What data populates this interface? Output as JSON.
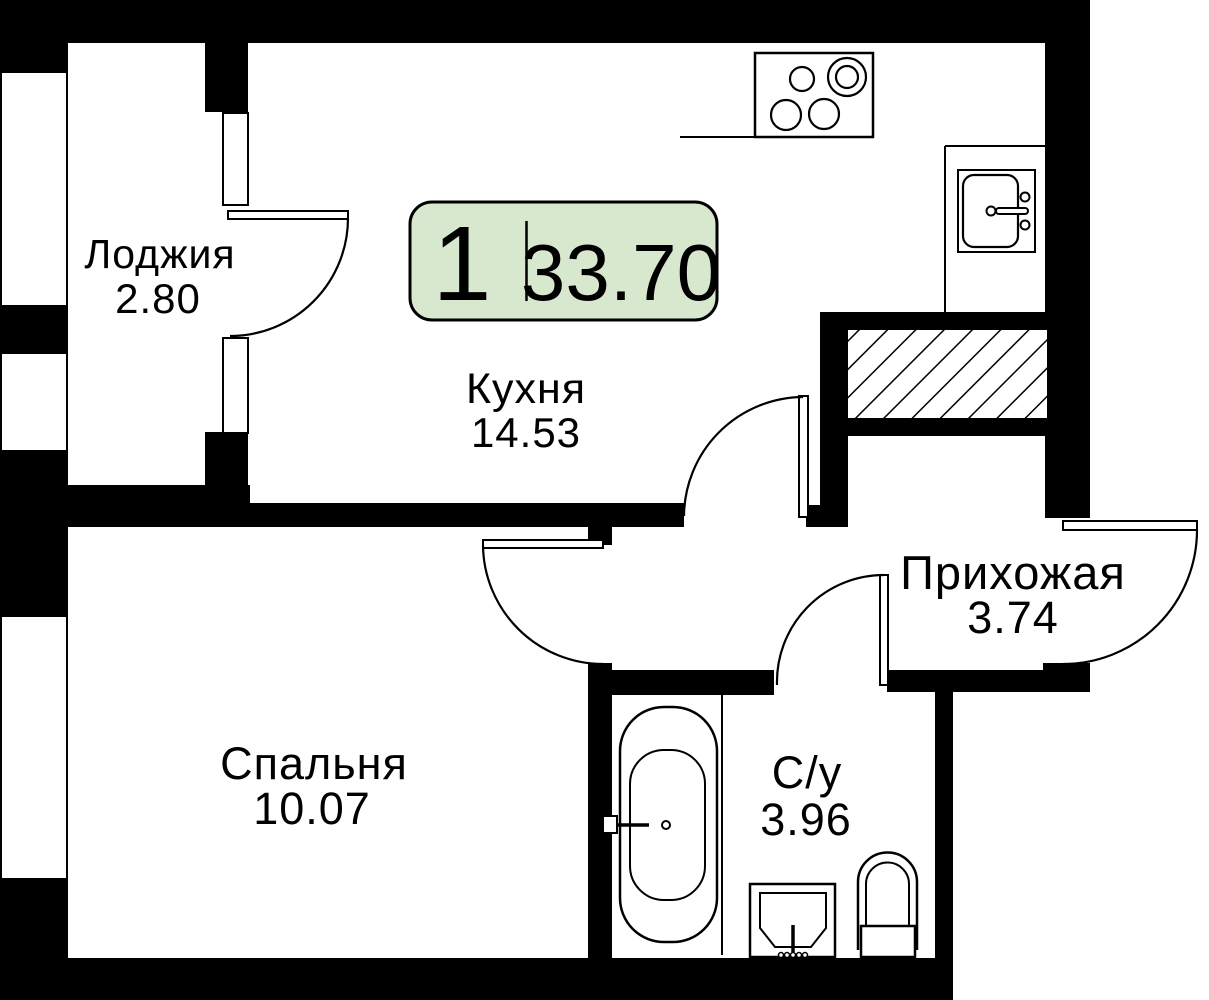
{
  "unit": {
    "badge": {
      "rooms_count": "1",
      "total_area": "33.70"
    },
    "colors": {
      "badge_bg": "#d8e8cf",
      "badge_border": "#000000",
      "walls": "#000000",
      "paper": "#ffffff",
      "line": "#000000"
    }
  },
  "rooms": {
    "loggia": {
      "name": "Лоджия",
      "area": "2.80"
    },
    "kitchen": {
      "name": "Кухня",
      "area": "14.53"
    },
    "hallway": {
      "name": "Прихожая",
      "area": "3.74"
    },
    "bedroom": {
      "name": "Спальня",
      "area": "10.07"
    },
    "bathroom": {
      "name": "С/у",
      "area": "3.96"
    }
  }
}
